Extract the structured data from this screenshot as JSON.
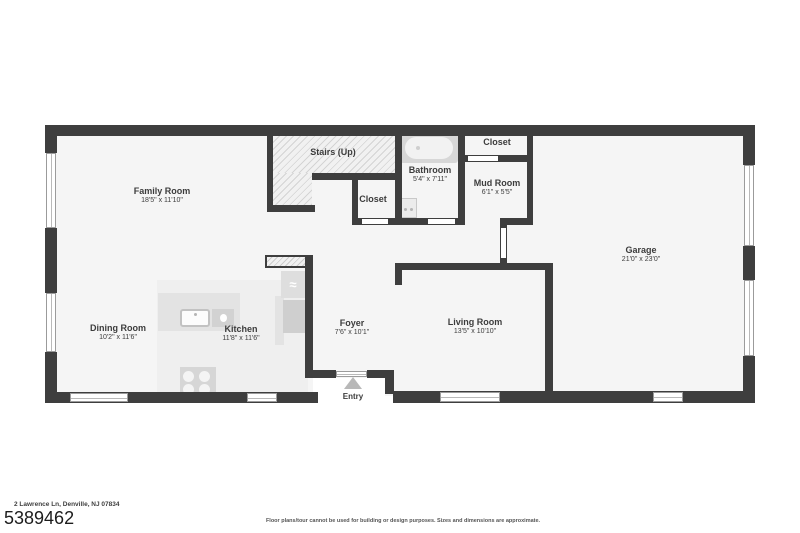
{
  "plan": {
    "rooms": [
      {
        "name": "Family Room",
        "dims": "18'5\" x 11'10\""
      },
      {
        "name": "Stairs (Up)",
        "dims": ""
      },
      {
        "name": "Closet",
        "dims": ""
      },
      {
        "name": "Bathroom",
        "dims": "5'4\" x 7'11\""
      },
      {
        "name": "Closet",
        "dims": ""
      },
      {
        "name": "Mud Room",
        "dims": "6'1\" x 5'5\""
      },
      {
        "name": "Garage",
        "dims": "21'0\" x 23'0\""
      },
      {
        "name": "Dining Room",
        "dims": "10'2\" x 11'6\""
      },
      {
        "name": "Kitchen",
        "dims": "11'8\" x 11'6\""
      },
      {
        "name": "Foyer",
        "dims": "7'6\" x 10'1\""
      },
      {
        "name": "Living Room",
        "dims": "13'5\" x 10'10\""
      }
    ],
    "entry_label": "Entry",
    "fixtures": [
      "bathtub",
      "bathroom-sink",
      "kitchen-sink",
      "dishwasher",
      "refrigerator",
      "stove",
      "entry-arrow"
    ],
    "refrigerator_glyph": "≈"
  },
  "footer": {
    "address": "2 Lawrence Ln, Denville, NJ 07834",
    "mls_number": "5389462",
    "disclaimer": "Floor plans/tour cannot be used for building or design purposes. Sizes and dimensions are approximate."
  },
  "colors": {
    "wall": "#3e3e3e",
    "floor": "#f5f5f5",
    "fixture_gray": "#d6d6d6",
    "arrow_gray": "#b8b8b8"
  }
}
